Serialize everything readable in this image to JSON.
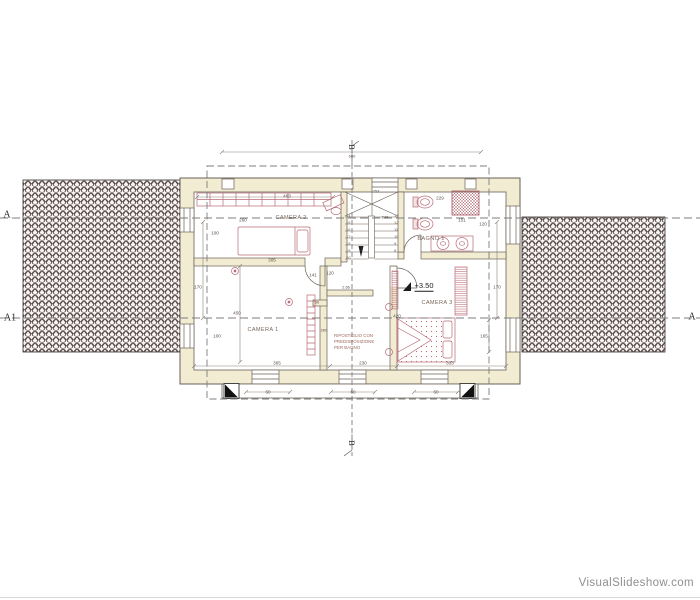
{
  "colors": {
    "wall_fill": "#f1ecd2",
    "furniture_pink": "#b96b76",
    "roof_hatch": "#55494a",
    "dashed_line": "#7d7d7d"
  },
  "watermark": {
    "text": "VisualSlideshow.com"
  },
  "section_markers": {
    "a_left": "A",
    "a1_left": "A1",
    "a_right": "A",
    "b_top": "B",
    "b_bottom": "B"
  },
  "rooms": {
    "camera1": "CAMERA 1",
    "camera2": "CAMERA 2",
    "camera3": "CAMERA 3",
    "bagno": "BAGNO 1",
    "ripostiglio": "RIPOSTIGLIO CON\nPREDISPOSIZIONE\nPER BAGNO",
    "level": "+3.50"
  },
  "dims": {
    "overall_width": "600",
    "wardrobe": "463",
    "camera2_width": "260",
    "window_top_left": "100",
    "camera2_bottom": "305",
    "hall_a": "141",
    "hall_b": "120",
    "corridor": "2.66",
    "wall_stub": "50",
    "ripostiglio_depth": "260",
    "camera1_height": "450",
    "offset_left": "170",
    "window_bottom_left": "100",
    "camera1_width": "365",
    "ripostiglio_width": "230",
    "camera3_width": "333",
    "window_b1": "60",
    "window_b2": "60",
    "window_b3": "60",
    "camera3_height": "420",
    "camera3_right": "165",
    "shower": "229",
    "window_right_a": "151",
    "window_right_b": "120",
    "offset_right": "170",
    "stair_top": "253",
    "stair_mid": "248"
  },
  "stairs": {
    "left_steps": "14\n15\n16\n17\n18\n19\n20",
    "right_steps": "13\n12\n11\n10\n9\n8"
  }
}
